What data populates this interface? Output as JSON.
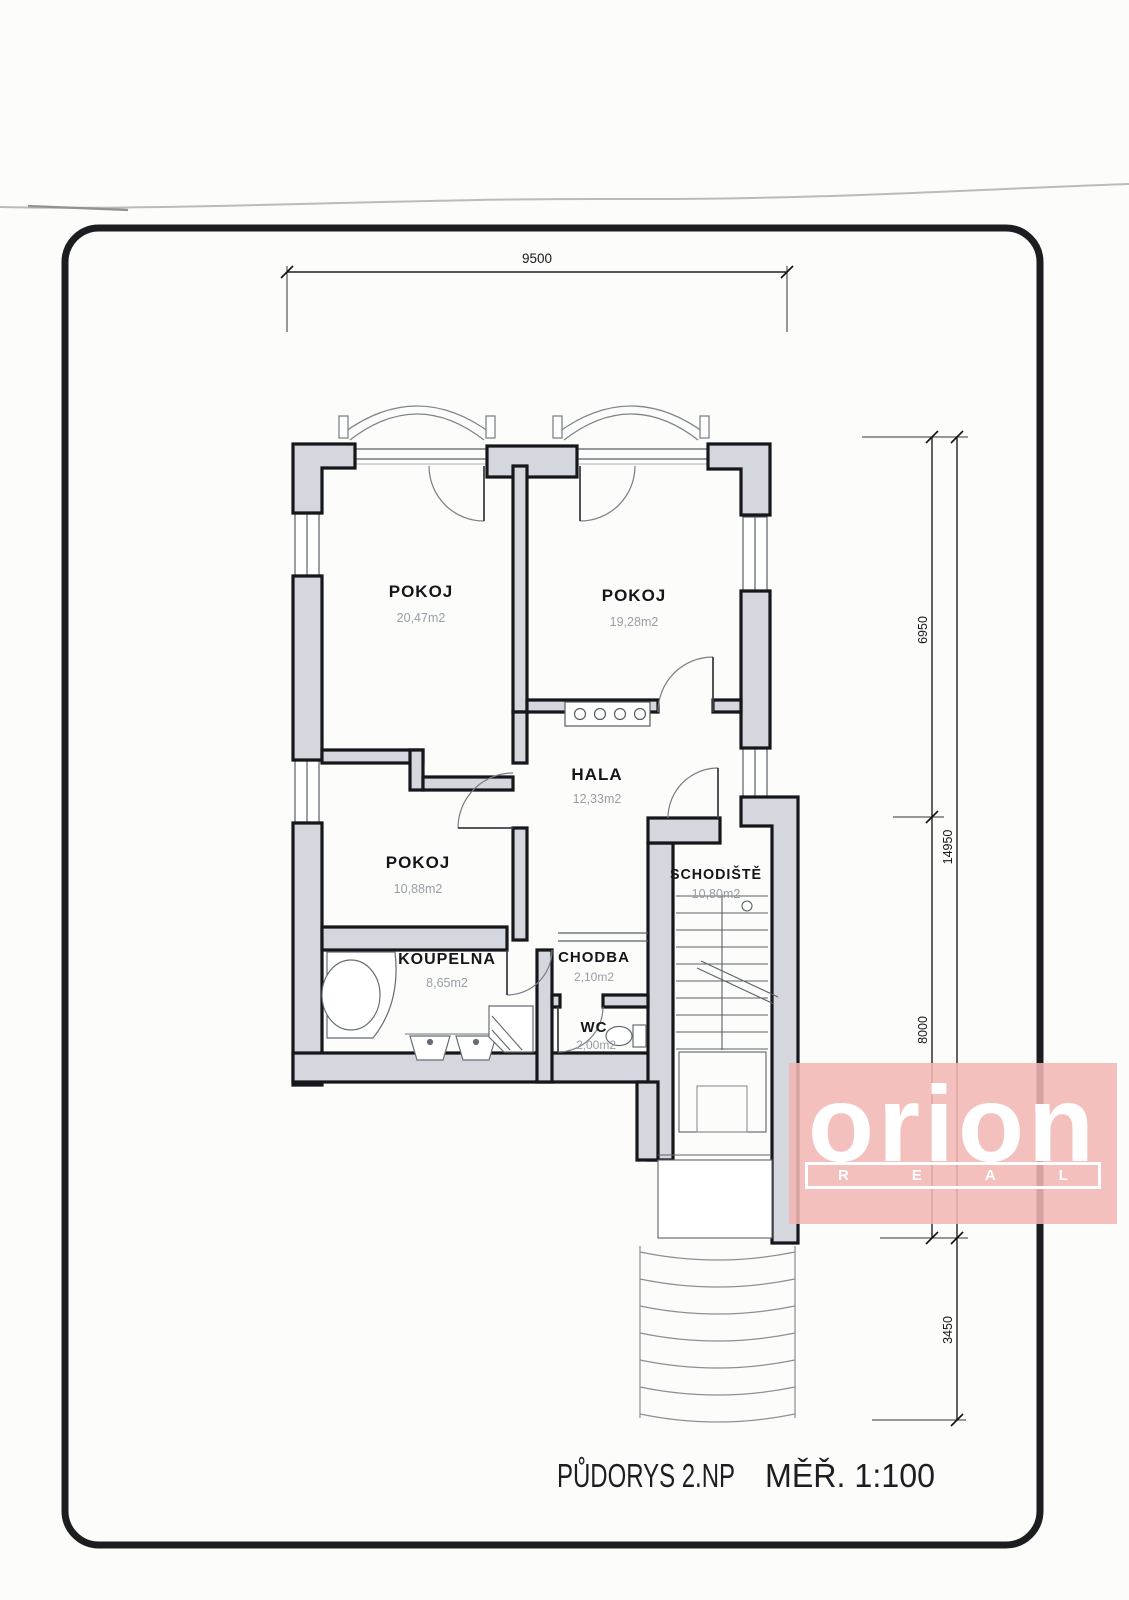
{
  "document": {
    "drawing_label": "PŮDORYS 2.NP",
    "scale_label": "MĚŘ. 1:100"
  },
  "rooms": {
    "pokoj1": {
      "name": "POKOJ",
      "area": "20,47m2"
    },
    "pokoj2": {
      "name": "POKOJ",
      "area": "19,28m2"
    },
    "hala": {
      "name": "HALA",
      "area": "12,33m2"
    },
    "pokoj3": {
      "name": "POKOJ",
      "area": "10,88m2"
    },
    "schodiste": {
      "name": "SCHODIŠTĚ",
      "area": "10,80m2"
    },
    "koupelna": {
      "name": "KOUPELNA",
      "area": "8,65m2"
    },
    "chodba": {
      "name": "CHODBA",
      "area": "2,10m2"
    },
    "wc": {
      "name": "WC",
      "area": "2,00m2"
    }
  },
  "dimensions": {
    "top_width": "9500",
    "right_upper": "6950",
    "right_total": "14950",
    "right_lower": "8000",
    "right_entry": "3450"
  },
  "logo": {
    "brand": "orion",
    "sub_letters": [
      "R",
      "E",
      "A",
      "L"
    ],
    "background": "#f2b7b4",
    "text_color": "#ffffff"
  },
  "colors": {
    "wall_fill": "#d4d8de",
    "line": "#15171a"
  }
}
